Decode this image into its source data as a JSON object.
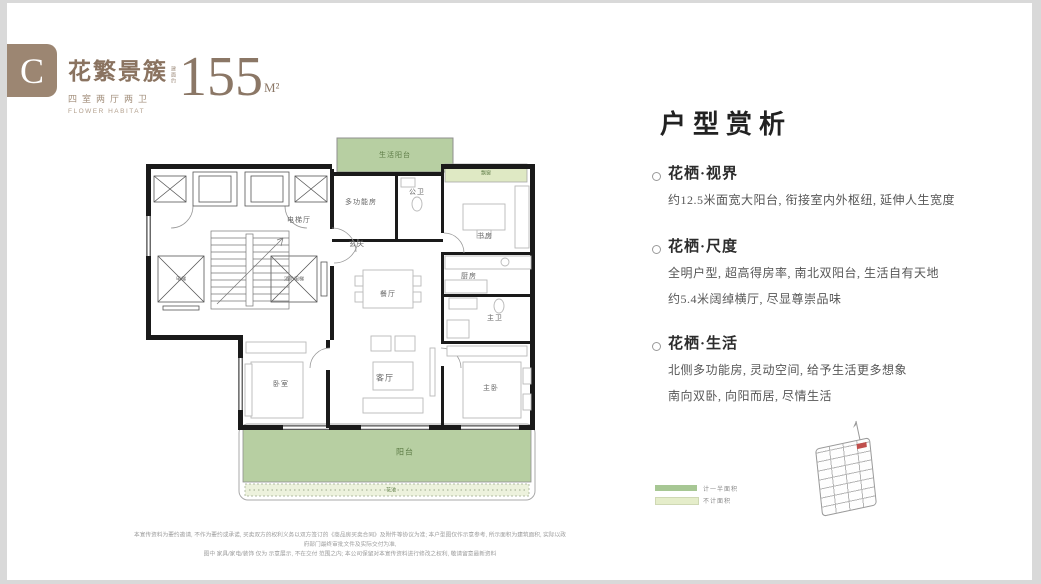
{
  "header": {
    "badge": "C",
    "title": "花繁景簇",
    "subtitle": "四室两厅两卫",
    "subtitle_en": "FLOWER HABITAT",
    "area_prefix": "建面约",
    "area_value": "155",
    "area_unit": "M²"
  },
  "colors": {
    "brand_brown": "#9c8672",
    "balcony_green": "#b7cfa2",
    "bay_window_green": "#dfe9c4",
    "planter_green": "#edf2dd",
    "wall_black": "#1a1a1a",
    "highlight_red": "#c0504d"
  },
  "floorplan": {
    "rooms": {
      "life_balcony": "生活阳台",
      "multi_room": "多功能房",
      "public_bath": "公卫",
      "bay_window": "飘窗",
      "study": "书房",
      "elevator_hall": "电梯厅",
      "foyer": "玄关",
      "dining": "餐厅",
      "kitchen": "厨房",
      "master_bath": "主卫",
      "living": "客厅",
      "bedroom": "卧室",
      "master_bedroom": "主卧",
      "balcony": "阳台",
      "planter": "花池",
      "elevator": "电梯",
      "fire_elevator": "消防电梯"
    }
  },
  "analysis": {
    "title": "户型赏析",
    "sections": [
      {
        "heading": "花栖·视界",
        "lines": [
          "约12.5米面宽大阳台, 衔接室内外枢纽, 延伸人生宽度"
        ]
      },
      {
        "heading": "花栖·尺度",
        "lines": [
          "全明户型, 超高得房率, 南北双阳台, 生活自有天地",
          "约5.4米阔绰横厅, 尽显尊崇品味"
        ]
      },
      {
        "heading": "花栖·生活",
        "lines": [
          "北侧多功能房, 灵动空间, 给予生活更多想象",
          "南向双卧, 向阳而居, 尽情生活"
        ]
      }
    ]
  },
  "legend": {
    "items": [
      {
        "label": "计一半面积",
        "color": "#a7c794"
      },
      {
        "label": "不计面积",
        "color": "#e5edca"
      }
    ]
  },
  "disclaimer": {
    "line1": "本宣传资料为要约邀请, 不作为要约或承诺, 买卖双方的权利义务以双方签订的《商品房买卖合同》及附件等协议为准; 本户型图仅作示意参考, 所示面积为建筑面积, 实际以政府部门最终审批文件及实际交付为准,",
    "line2": "图中 家具/家电/装饰 仅为 示意展示, 不在交付 范围之内; 本公司保留对本宣传资料进行修改之权利, 敬请留意最新资料"
  }
}
